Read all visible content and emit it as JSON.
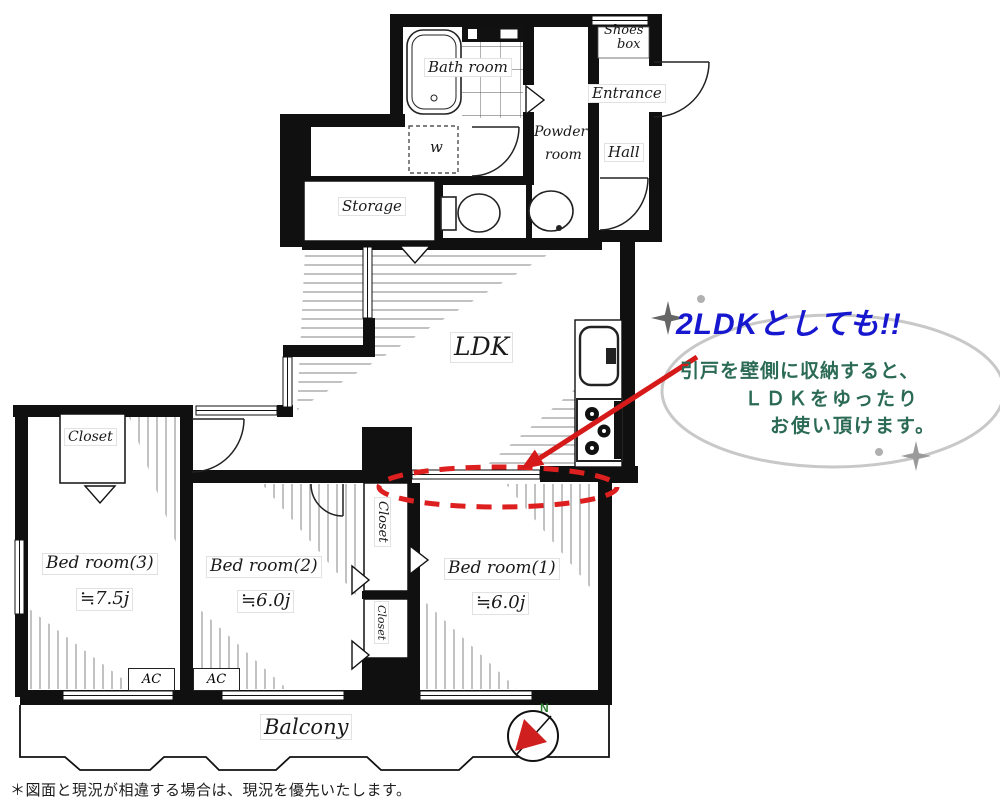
{
  "plan": {
    "rooms": {
      "bath": "Bath room",
      "shoes_box": [
        "Shoes",
        "box"
      ],
      "entrance": "Entrance",
      "powder": [
        "Powder",
        "room"
      ],
      "hall": "Hall",
      "storage": "Storage",
      "washer": "w",
      "ldk": "LDK",
      "balcony": "Balcony",
      "closet": "Closet",
      "ac": "AC"
    },
    "bedrooms": [
      {
        "name": "Bed room(1)",
        "size": "≒6.0j"
      },
      {
        "name": "Bed room(2)",
        "size": "≒6.0j"
      },
      {
        "name": "Bed room(3)",
        "size": "≒7.5j"
      }
    ]
  },
  "annotation": {
    "title": "2LDKとしても!!",
    "lines": [
      "引戸を壁側に収納すると、",
      "ＬＤＫをゆったり",
      "お使い頂けます。"
    ],
    "title_color": "#1717cf",
    "body_color": "#2b6a55",
    "highlight_color": "#dd1f1f"
  },
  "compass": {
    "north": "N",
    "north_color": "#2e7d32"
  },
  "footer": {
    "disclaimer": "＊図面と現況が相違する場合は、現況を優先いたします。"
  }
}
